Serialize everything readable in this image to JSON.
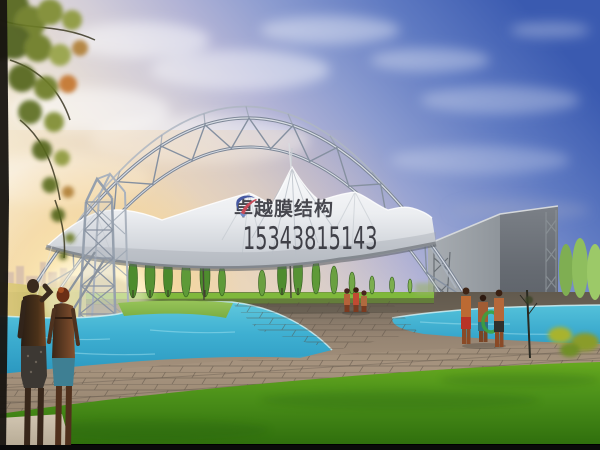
{
  "watermark": {
    "company_name": "卓越膜结构",
    "phone_number": "15343815143"
  },
  "scene": {
    "palette": {
      "sky_blue": "#3a5ab0",
      "sunset_glow": "#fbe7b2",
      "membrane_white": "#f8f9fa",
      "steel_gray": "#8e98a8",
      "pool_turquoise": "#3fb0d2",
      "grass_green": "#4d921a",
      "paving_tan": "#958472",
      "wall_gray": "#70757c",
      "watermark_text": "#2b2b33",
      "logo_red": "#c23040",
      "logo_blue": "#2a3f95"
    }
  }
}
